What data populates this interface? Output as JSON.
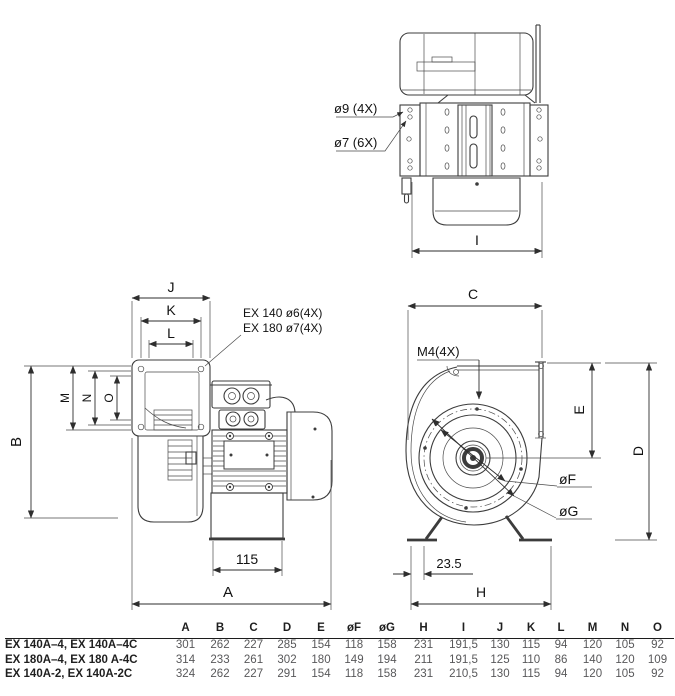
{
  "drawing": {
    "top_view": {
      "callout_hole_large": "ø9 (4X)",
      "callout_hole_small": "ø7 (6X)",
      "dim_depth": "I"
    },
    "side_view": {
      "dim_j": "J",
      "dim_k": "K",
      "dim_l": "L",
      "dim_m": "M",
      "dim_n": "N",
      "dim_o": "O",
      "dim_b": "B",
      "dim_a": "A",
      "dim_motor_base": "115",
      "callout_line1": "EX 140 ø6(4X)",
      "callout_line2": "EX 180 ø7(4X)"
    },
    "front_view": {
      "dim_c": "C",
      "dim_e": "E",
      "dim_d": "D",
      "dim_h": "H",
      "dim_f": "øF",
      "dim_g": "øG",
      "dim_foot_offset": "23.5",
      "callout_thread": "M4(4X)"
    }
  },
  "table": {
    "headers": [
      "A",
      "B",
      "C",
      "D",
      "E",
      "øF",
      "øG",
      "H",
      "I",
      "J",
      "K",
      "L",
      "M",
      "N",
      "O"
    ],
    "rows": [
      {
        "model": "EX 140A–4, EX 140A–4C",
        "values": [
          "301",
          "262",
          "227",
          "285",
          "154",
          "118",
          "158",
          "231",
          "191,5",
          "130",
          "115",
          "94",
          "120",
          "105",
          "92"
        ]
      },
      {
        "model": "EX 180A–4, EX 180 A-4C",
        "values": [
          "314",
          "233",
          "261",
          "302",
          "180",
          "149",
          "194",
          "211",
          "191,5",
          "125",
          "110",
          "86",
          "140",
          "120",
          "109"
        ]
      },
      {
        "model": "EX 140A-2, EX 140A-2C",
        "values": [
          "324",
          "262",
          "227",
          "291",
          "154",
          "118",
          "158",
          "231",
          "210,5",
          "130",
          "115",
          "94",
          "120",
          "105",
          "92"
        ]
      }
    ]
  },
  "colors": {
    "line": "#3c3c3c",
    "text": "#121212",
    "table_value": "#58585a"
  }
}
